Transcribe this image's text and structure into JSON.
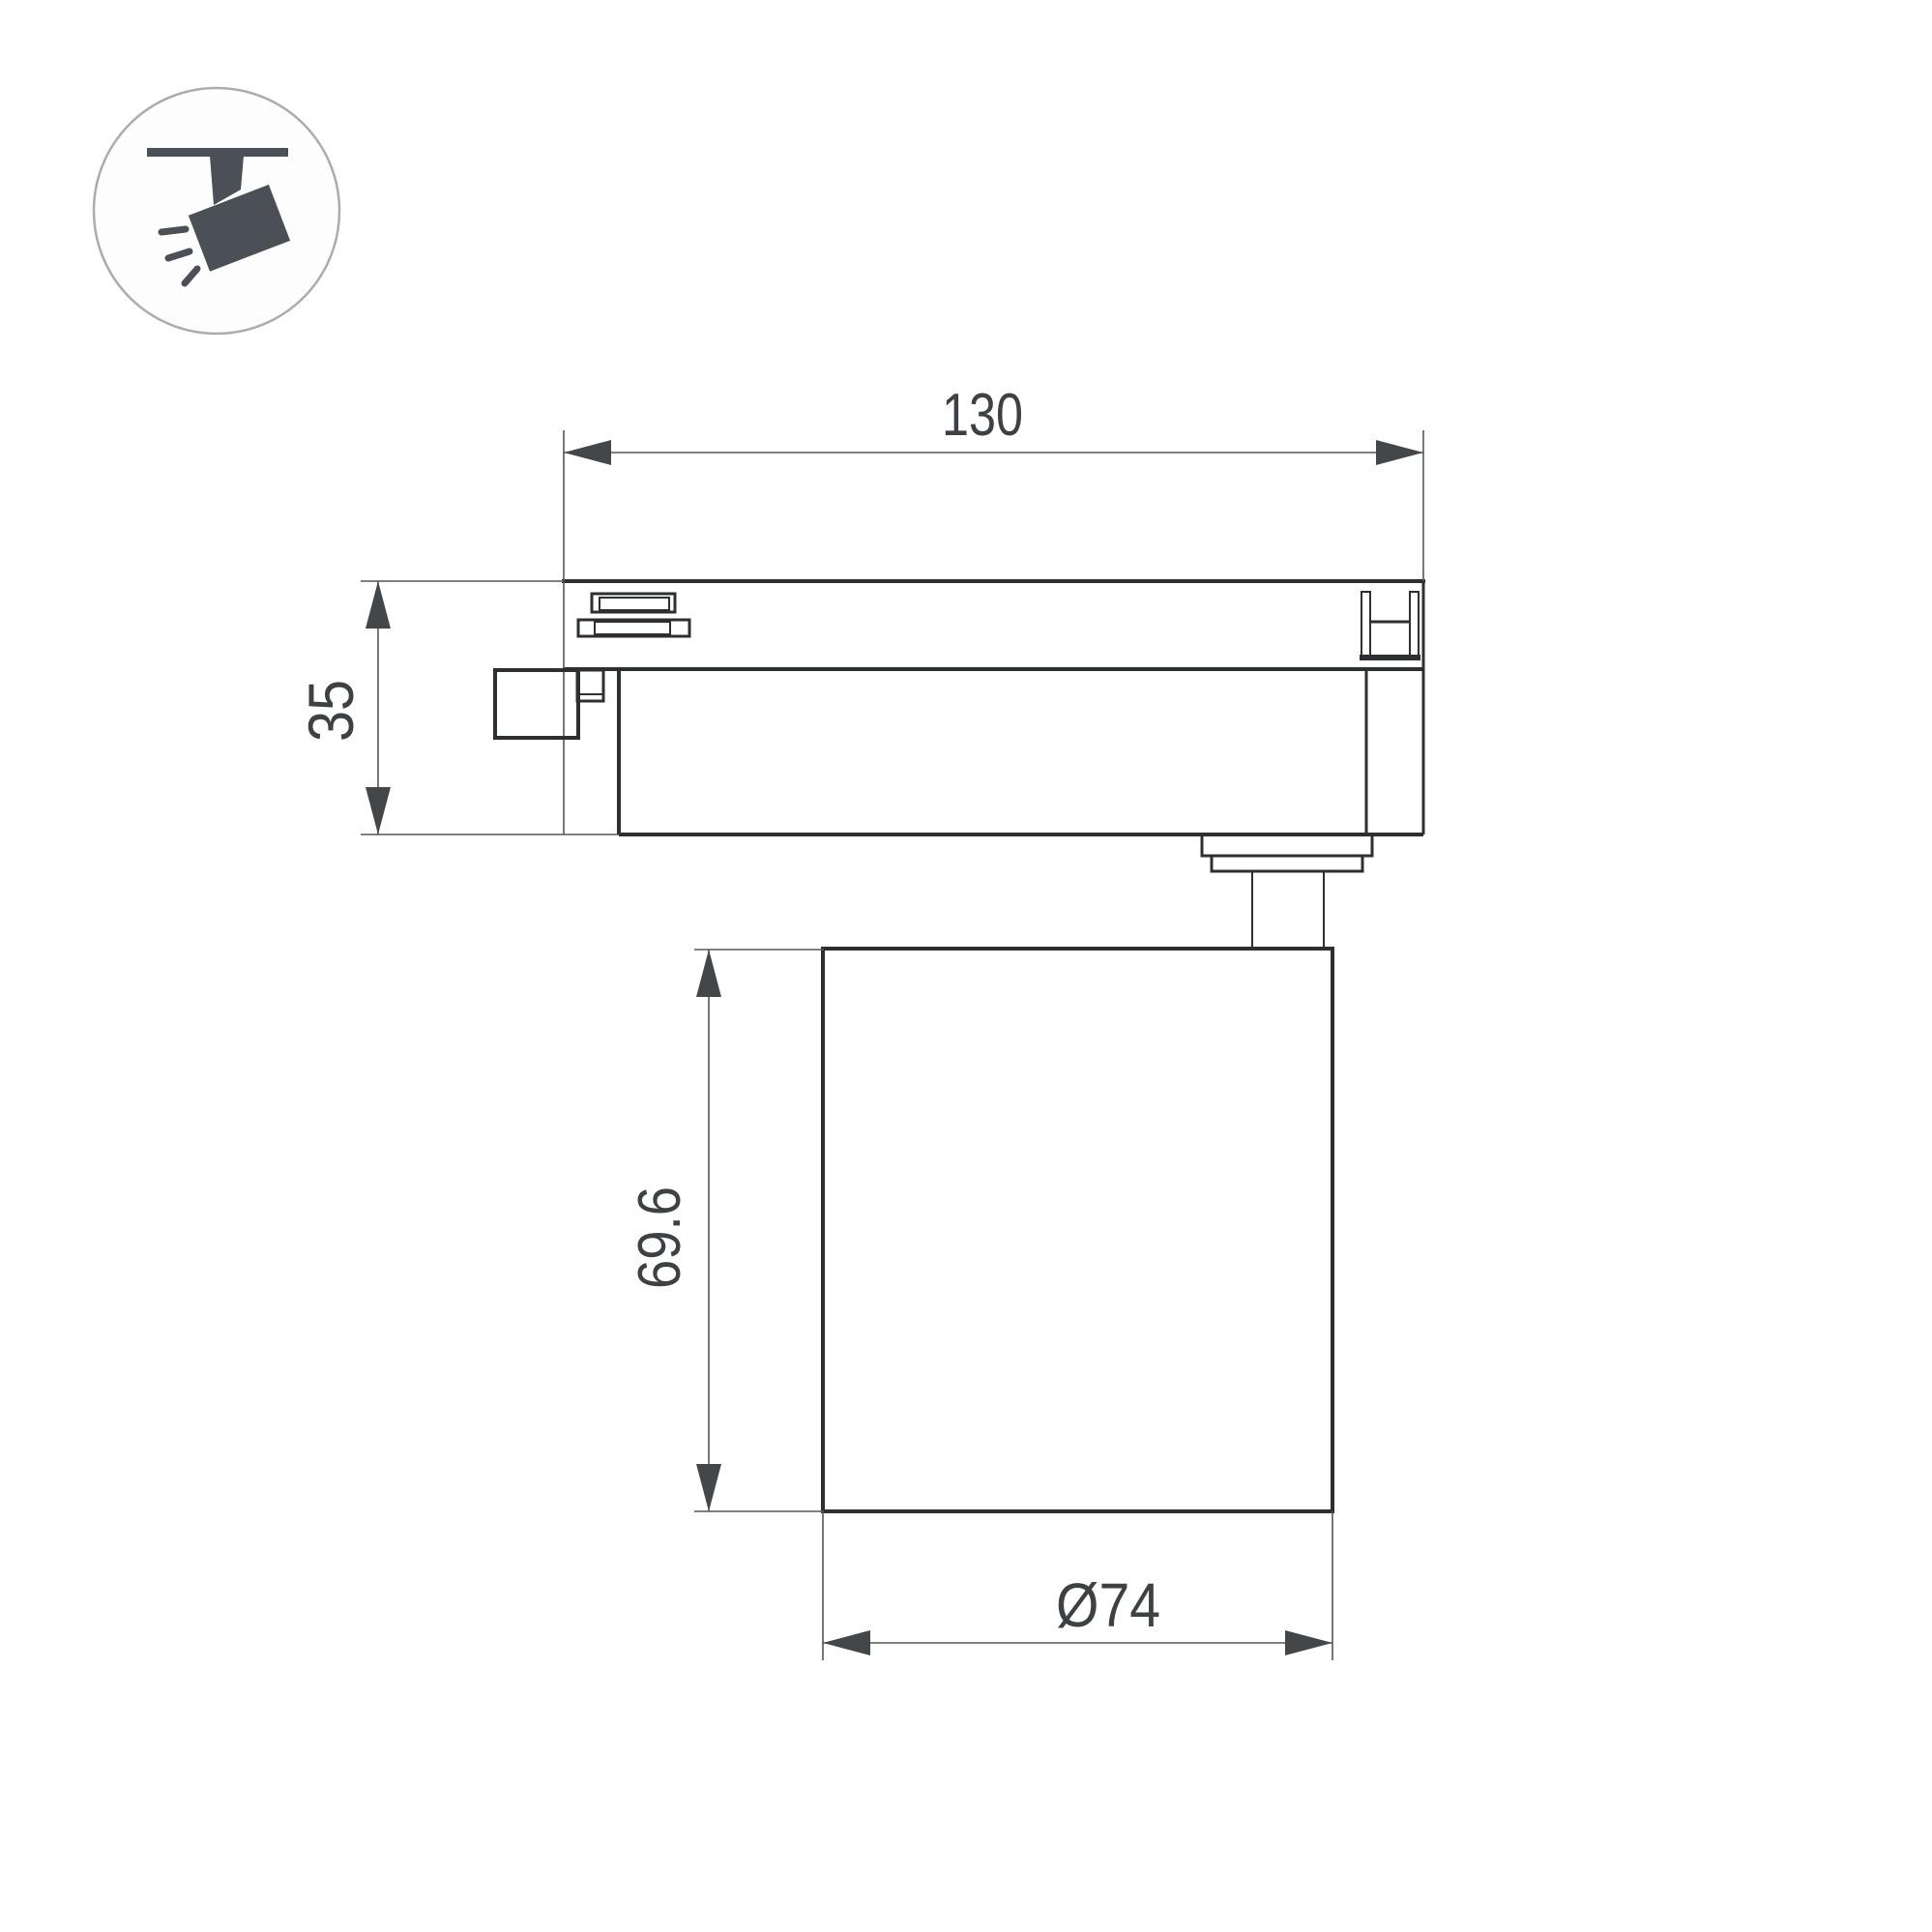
{
  "page": {
    "background": "#ffffff",
    "type": "technical-dimension-drawing",
    "subject": "LED track spotlight side view"
  },
  "icon": {
    "name": "track-spotlight-icon",
    "shape_fill": "#4a5056",
    "circle_stroke": "#a9adb0"
  },
  "drawing": {
    "line_color": "#2d3033",
    "thin_line_color": "#54575a",
    "text_color": "#3e4144",
    "dimensions": {
      "track_width": {
        "label": "130",
        "orientation": "horizontal",
        "measures": "track adapter length"
      },
      "adapter_height": {
        "label": "35",
        "orientation": "vertical",
        "measures": "track adapter height"
      },
      "body_height": {
        "label": "69.6",
        "orientation": "vertical",
        "measures": "lamp body height"
      },
      "body_diameter": {
        "label": "Ø74",
        "orientation": "horizontal",
        "measures": "lamp body diameter"
      }
    }
  }
}
